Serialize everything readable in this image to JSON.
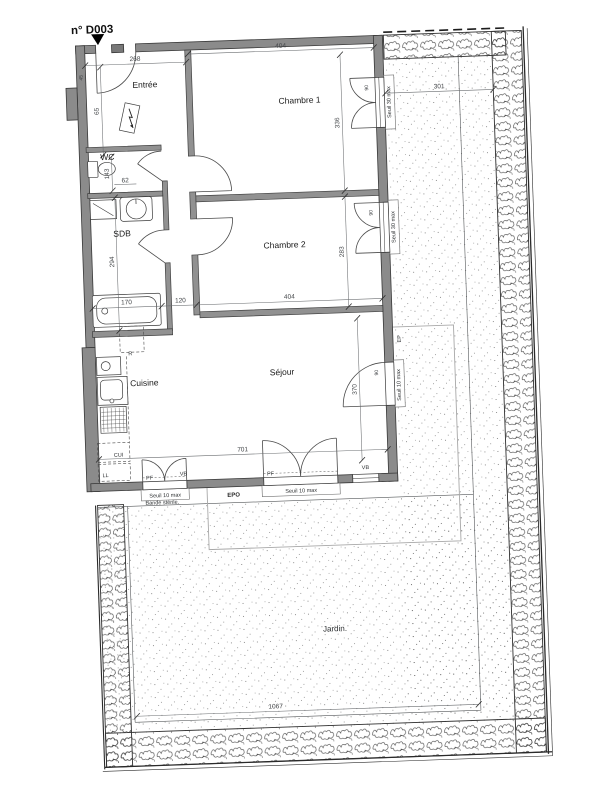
{
  "title": "n° D003",
  "rooms": {
    "entree": "Entrée",
    "wc": "WC",
    "sdb": "SDB",
    "cuisine": "Cuisine",
    "chambre1": "Chambre 1",
    "chambre2": "Chambre 2",
    "sejour": "Séjour",
    "jardin": "Jardin."
  },
  "dimensions": {
    "d268": "268",
    "d404": "404",
    "d301": "301",
    "d65": "65",
    "d143": "143",
    "d62": "62",
    "d45": "45",
    "d336": "336",
    "d283": "283",
    "d294": "294",
    "d170": "170",
    "d120": "120",
    "d370": "370",
    "d701": "701",
    "d1067": "1067",
    "d90": "90"
  },
  "labels": {
    "seuil30": "Seuil 30 max",
    "seuil10": "Seuil 10 max",
    "pf": "PF",
    "vb": "VB",
    "cui": "CUI",
    "ll": "LL",
    "r": "R",
    "epo": "EPO",
    "ep": "EP",
    "bande": "Bande stérile."
  },
  "colors": {
    "wall_fill": "#8b8b8b",
    "wall_outline": "#383838",
    "dim_text": "#44474a",
    "stipple_dot": "#777777",
    "paper": "#ffffff"
  }
}
